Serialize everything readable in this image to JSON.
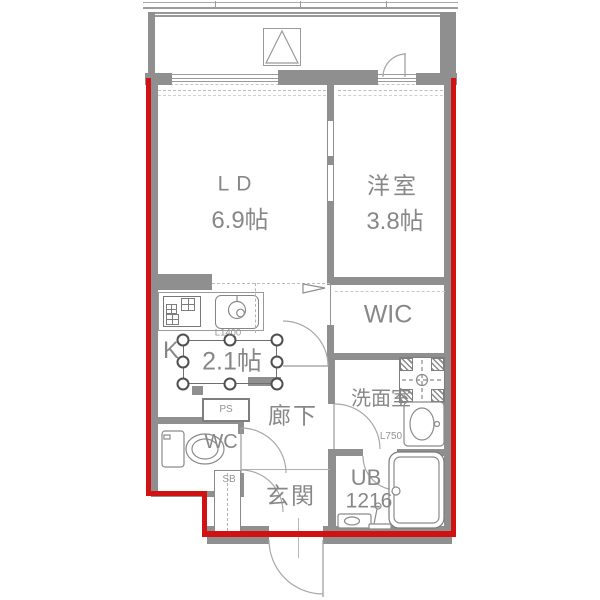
{
  "plan": {
    "outline_color": "#d01212",
    "wall_color": "#8f8f8f",
    "rooms": {
      "living_dining": {
        "label": "LD",
        "size": "6.9帖"
      },
      "western_room": {
        "label": "洋室",
        "size": "3.8帖"
      },
      "walk_in_closet": {
        "label": "WIC"
      },
      "kitchen": {
        "label": "K",
        "size": "2.1帖",
        "counter_length": "L1400"
      },
      "hallway": {
        "label": "廊下"
      },
      "toilet_room": {
        "label": "WC"
      },
      "pipe_space": {
        "label": "PS"
      },
      "shoe_box": {
        "label": "SB"
      },
      "entrance": {
        "label": "玄関"
      },
      "washroom": {
        "label": "洗面室",
        "vanity_length": "L750"
      },
      "unit_bath": {
        "label": "UB",
        "size": "1216"
      }
    },
    "selection": {
      "selected_text": "2.1帖",
      "handle_count": 8
    }
  }
}
